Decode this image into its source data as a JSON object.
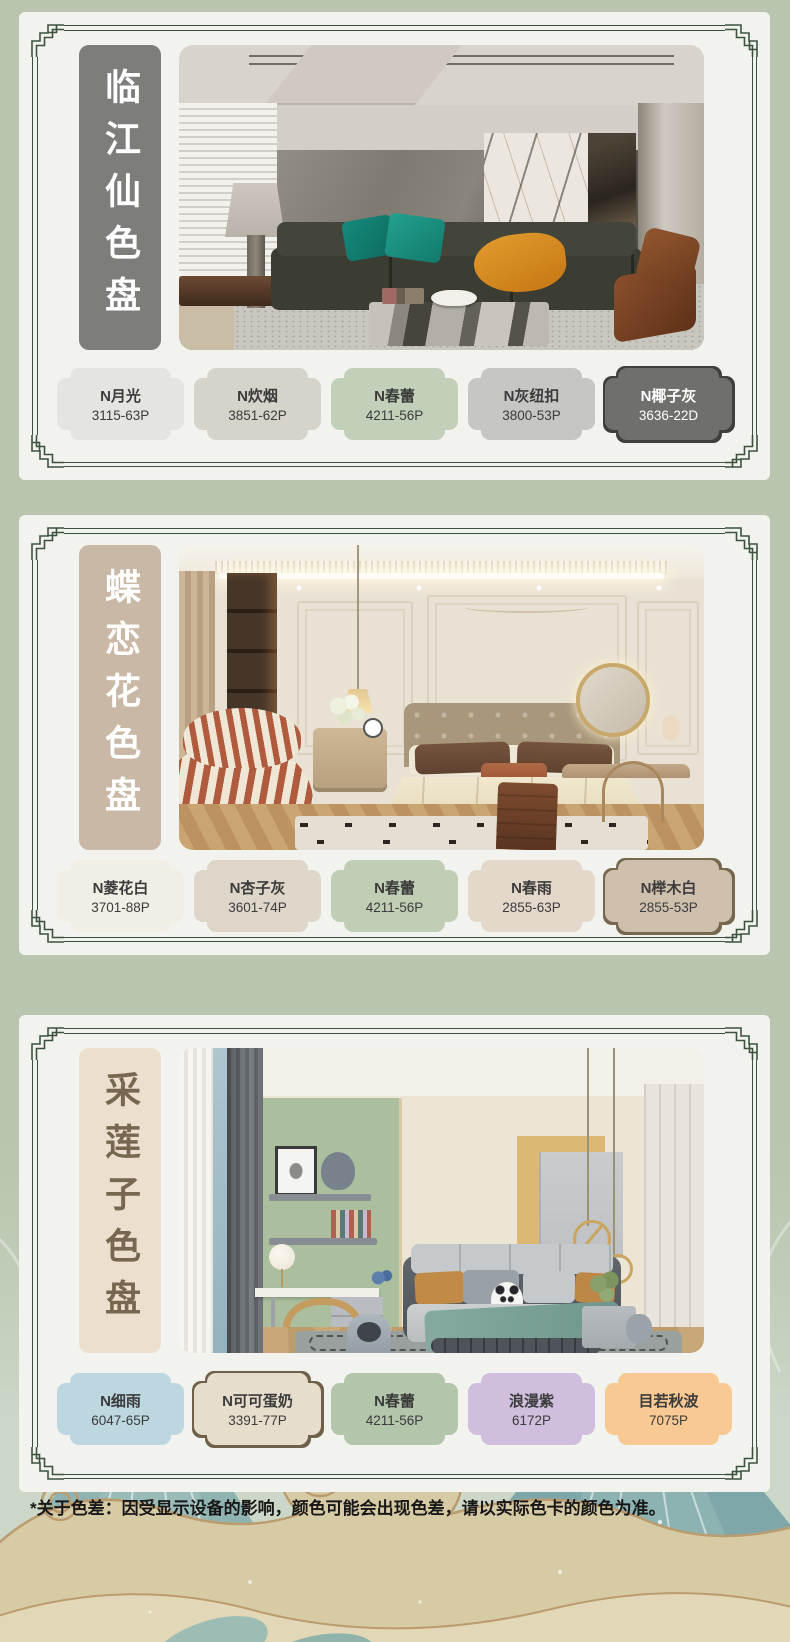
{
  "page": {
    "background": "#b9c5ae",
    "card_background": "#f2f3ee",
    "frame_color": "#3c523e",
    "disclaimer": "*关于色差：因受显示设备的影响，颜色可能会出现色差，请以实际色卡的颜色为准。"
  },
  "palettes": [
    {
      "title": "临江仙色盘",
      "title_bg": "#7d7d7b",
      "title_color": "#ffffff",
      "photo_alt": "现代客厅：深绿色沙发、青绿抱枕、橙色盖毯、大理石茶几与山石背景墙",
      "swatches": [
        {
          "name": "N月光",
          "code": "3115-63P",
          "color": "#e4e4e2"
        },
        {
          "name": "N炊烟",
          "code": "3851-62P",
          "color": "#d6d3ca"
        },
        {
          "name": "N春蕾",
          "code": "4211-56P",
          "color": "#c3d0b9"
        },
        {
          "name": "N灰纽扣",
          "code": "3800-53P",
          "color": "#c6c6c4"
        },
        {
          "name": "N椰子灰",
          "code": "3636-22D",
          "color": "#6f6f6d",
          "text_color": "#ffffff",
          "border_color": "#3f3f3d"
        }
      ]
    },
    {
      "title": "蝶恋花色盘",
      "title_bg": "#c9b8a5",
      "title_color": "#ffffff",
      "photo_alt": "法式奶油风卧室：石膏线墙面、棕色软包床头、米色床品与条纹休闲椅",
      "swatches": [
        {
          "name": "N菱花白",
          "code": "3701-88P",
          "color": "#f1eee5"
        },
        {
          "name": "N杏子灰",
          "code": "3601-74P",
          "color": "#ded6c8"
        },
        {
          "name": "N春蕾",
          "code": "4211-56P",
          "color": "#c0ceb6"
        },
        {
          "name": "N春雨",
          "code": "2855-63P",
          "color": "#e4d8ca"
        },
        {
          "name": "N榉木白",
          "code": "2855-53P",
          "color": "#cfc0ae",
          "border_color": "#77674f"
        }
      ]
    },
    {
      "title": "采莲子色盘",
      "title_bg": "#ecdfcd",
      "title_color": "#776750",
      "photo_alt": "儿童房：豆绿色墙面、灰色软床、玩偶与原木书桌椅",
      "swatches": [
        {
          "name": "N细雨",
          "code": "6047-65P",
          "color": "#bdd7e1"
        },
        {
          "name": "N可可蛋奶",
          "code": "3391-77P",
          "color": "#e7ddcc",
          "border_color": "#6f6049"
        },
        {
          "name": "N春蕾",
          "code": "4211-56P",
          "color": "#b3c5aa"
        },
        {
          "name": "浪漫紫",
          "code": "6172P",
          "color": "#cfbedd"
        },
        {
          "name": "目若秋波",
          "code": "7075P",
          "color": "#f8c992"
        }
      ]
    }
  ]
}
